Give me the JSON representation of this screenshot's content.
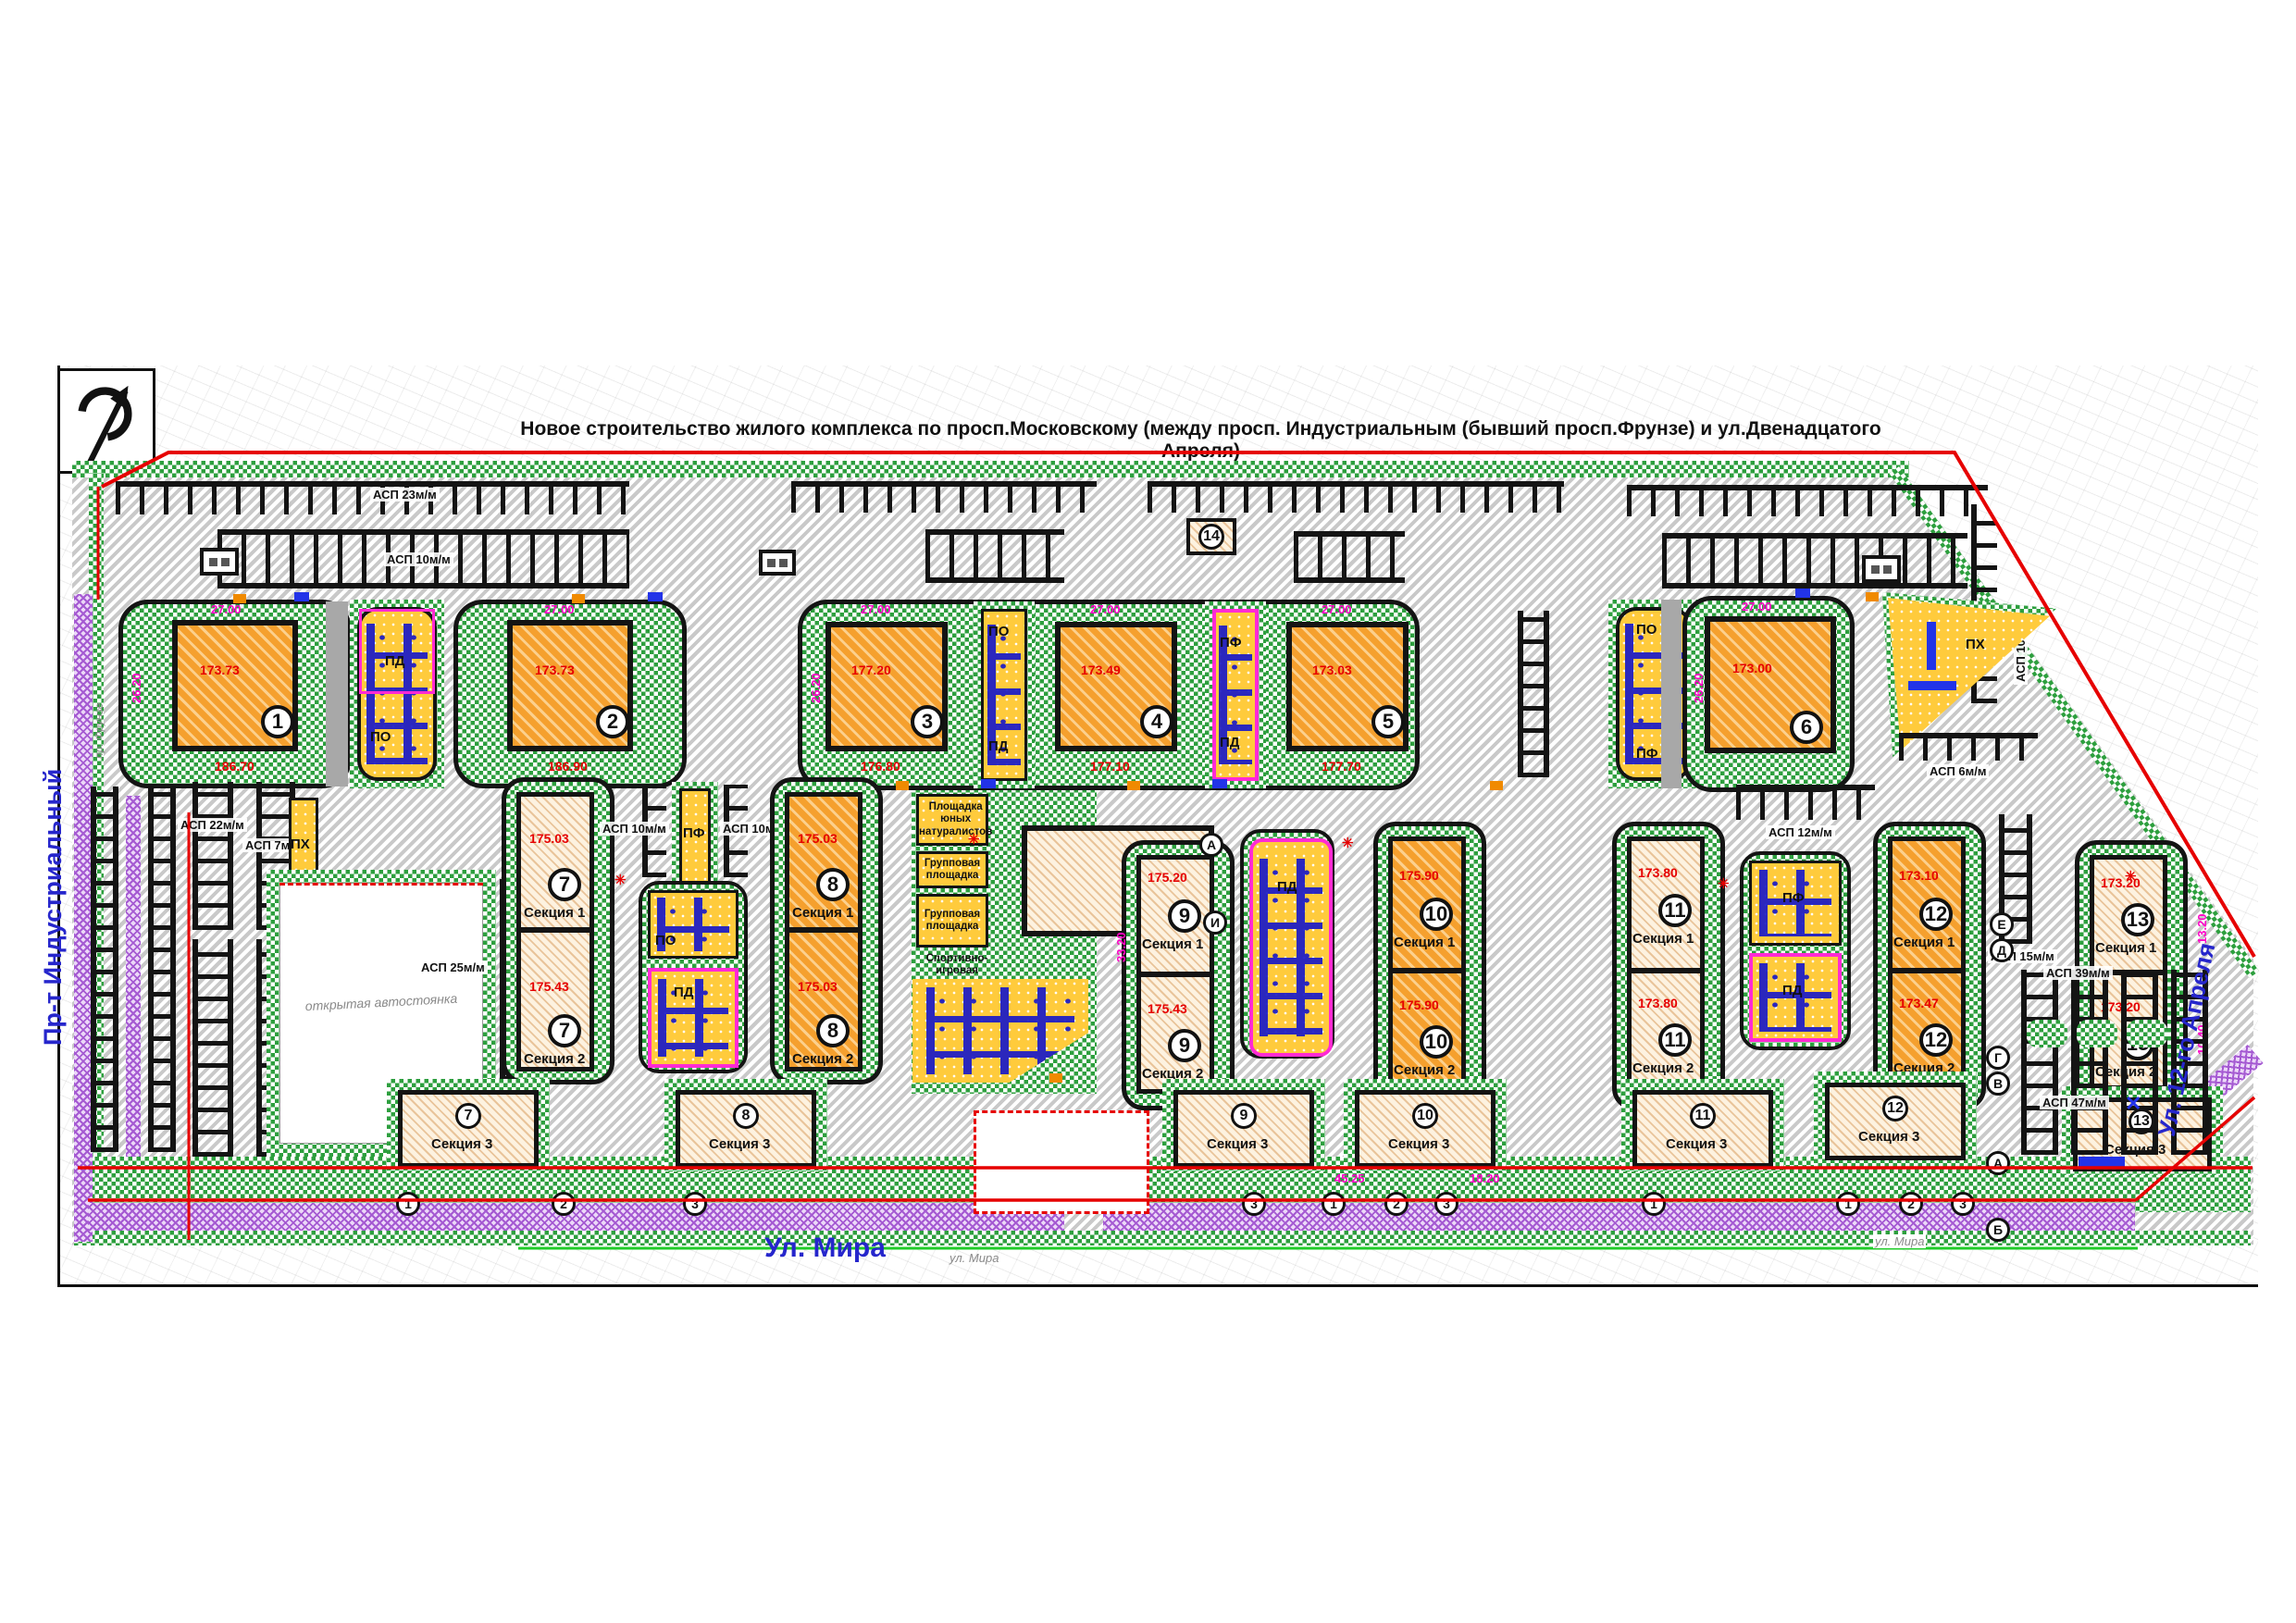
{
  "title": "Новое строительство жилого комплекса по просп.Московскому (между просп. Индустриальным (бывший просп.Фрунзе)  и ул.Двенадцатого Апреля)",
  "streets": {
    "left": "Пр-т Индустриальный",
    "left_old": "пр. Фрунзе",
    "bottom": "Ул. Мира",
    "bottom_survey": "ул. Мира",
    "right": "Ул. 12-го Апреля"
  },
  "towers": [
    {
      "num": "1",
      "elev": "173.73"
    },
    {
      "num": "2",
      "elev": "173.73"
    },
    {
      "num": "3",
      "elev": "177.20"
    },
    {
      "num": "4",
      "elev": "173.49"
    },
    {
      "num": "5",
      "elev": "173.03"
    },
    {
      "num": "6",
      "elev": "173.00"
    }
  ],
  "entrance_elev": {
    "b1": "186.70",
    "b2": "186.90",
    "b3": "176.80",
    "b4": "177.10",
    "b5": "177.70"
  },
  "slabs": [
    {
      "num": "7",
      "s1": "Секция 1",
      "s2": "Секция 2",
      "e1": "175.03",
      "e2": "175.43"
    },
    {
      "num": "8",
      "s1": "Секция 1",
      "s2": "Секция 2",
      "e1": "175.03",
      "e2": "175.03"
    },
    {
      "num": "9",
      "s1": "Секция 1",
      "s2": "Секция 2",
      "e1": "175.20",
      "e2": "175.43"
    },
    {
      "num": "10",
      "s1": "Секция 1",
      "s2": "Секция 2",
      "e1": "175.90",
      "e2": "175.90"
    },
    {
      "num": "11",
      "s1": "Секция 1",
      "s2": "Секция 2",
      "e1": "173.80",
      "e2": "173.80"
    },
    {
      "num": "12",
      "s1": "Секция 1",
      "s2": "Секция 2",
      "e1": "173.10",
      "e2": "173.47"
    },
    {
      "num": "13",
      "s1": "Секция 1",
      "s2": "Секция 2",
      "e1": "173.20",
      "e2": "173.20"
    }
  ],
  "section3": "Секция 3",
  "center_building": {
    "num": "16"
  },
  "service_building": {
    "num": "14"
  },
  "playgrounds": {
    "named": [
      "Площадка юных натуралистов",
      "Групповая площадка",
      "Групповая площадка",
      "Спортивно-игровая площадка"
    ],
    "pd": "ПД",
    "po": "ПО",
    "pf": "ПФ",
    "ph": "ПХ"
  },
  "parking": {
    "asp23": "АСП 23м/м",
    "asp10": "АСП 10м/м",
    "asp22": "АСП 22м/м",
    "asp7": "АСП 7м/м",
    "asp25": "АСП 25м/м",
    "asp12": "АСП 12м/м",
    "asp15": "АСП 15м/м",
    "asp6": "АСП 6м/м",
    "asp39": "АСП 39м/м",
    "asp47": "АСП 47м/м"
  },
  "annotations": {
    "open_parking": "открытая автостоянка"
  },
  "dims": {
    "d27": "27.00",
    "d26": "26.20",
    "d33": "33.20",
    "d13": "13.20",
    "d10": "10.40",
    "d45": "45.25",
    "d18": "18.20"
  },
  "axes": {
    "letters": [
      "А",
      "Б",
      "В",
      "Г",
      "Д",
      "Е",
      "И"
    ],
    "numbers": [
      "1",
      "2",
      "3"
    ]
  },
  "colors": {
    "greenery": "#2D9F3E",
    "tower_fill": "#F5A02E",
    "section_fill": "#F7E3C4",
    "playground": "#FFCB3C",
    "playground_border": "#FF2AD4",
    "road_hatch": "#C9C9C9",
    "roadway": "#A8A8A8",
    "boundary_red": "#E60000",
    "street_blue": "#2626CC",
    "sidewalk_purple": "#A55AD2",
    "equipment_blue": "#1A1AC8"
  }
}
